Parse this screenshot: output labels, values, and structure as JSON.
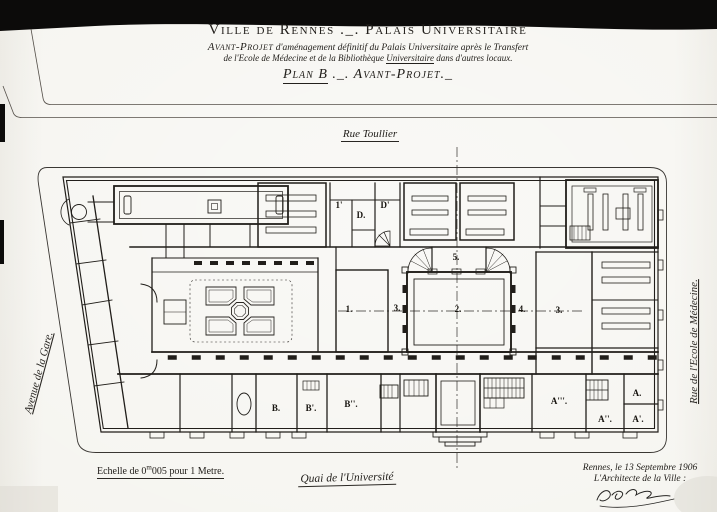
{
  "colors": {
    "paper": "#f4f3ee",
    "ink": "#23201c",
    "photo_band": "#0c0b0a"
  },
  "title_block": {
    "line1": "Ville de Rennes ._. Palais Universitaire",
    "line2_lead": "Avant-Projet",
    "line2_rest": "d'aménagement définitif du Palais Universitaire après le Transfert",
    "line3_pre": "de l'Ecole de Médecine et de la Bibliothèque ",
    "line3_underlined": "Universitaire",
    "line3_post": " dans d'autres locaux.",
    "line4_lead": "Plan B",
    "line4_rest": "._. Avant-Projet._"
  },
  "streets": {
    "top": "Rue Toullier",
    "left": "Avenue de la Gare.",
    "right": "Rue de l'Ecole de Médecine.",
    "bottom": "Quai de l'Université"
  },
  "footer": {
    "scale_pre": "Echelle de 0",
    "scale_sup": "m",
    "scale_post": "005 pour 1 Metre.",
    "place_date": "Rennes, le 13 Septembre 1906",
    "signatory": "L'Architecte de la Ville :"
  },
  "rooms": {
    "r1": "1.",
    "r1p": "1'",
    "r2": "2.",
    "r3w": "3.",
    "r3e": "3.",
    "r4": "4.",
    "r5": "5.",
    "rd": "D.",
    "rdp": "D'",
    "rb": "B.",
    "rbp": "B'.",
    "rbpp": "B''.",
    "ra": "A.",
    "rap": "A'.",
    "rapp": "A''.",
    "rappp": "A'''."
  }
}
